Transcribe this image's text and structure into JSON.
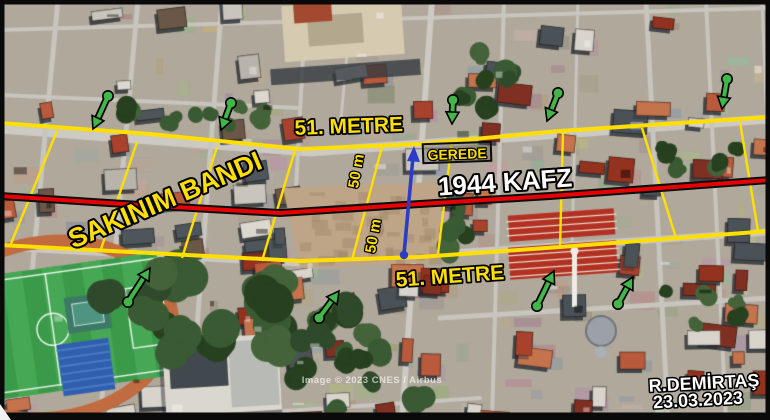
{
  "annotations": {
    "band_name": "SAKINIM BANDI",
    "fault_label": "1944 KAFZ",
    "band_width_top": "51. METRE",
    "band_width_bottom": "51. METRE",
    "half_width_upper": "50 m",
    "half_width_lower": "50 m",
    "place": "GEREDE",
    "author": "R.DEMİRTAŞ",
    "date": "23.03.2023"
  },
  "map": {
    "imagery_credit": "Image © 2023 CNES / Airbus"
  },
  "colors": {
    "band_line": "#ffdf00",
    "fault_line": "#e60000",
    "fault_casing": "#0d0d0d",
    "green_arrow": "#41b649",
    "measure_arrow": "#2b3cc8",
    "label_yellow": "#ffdf00",
    "label_white": "#ffffff",
    "outline_black": "#000000"
  }
}
